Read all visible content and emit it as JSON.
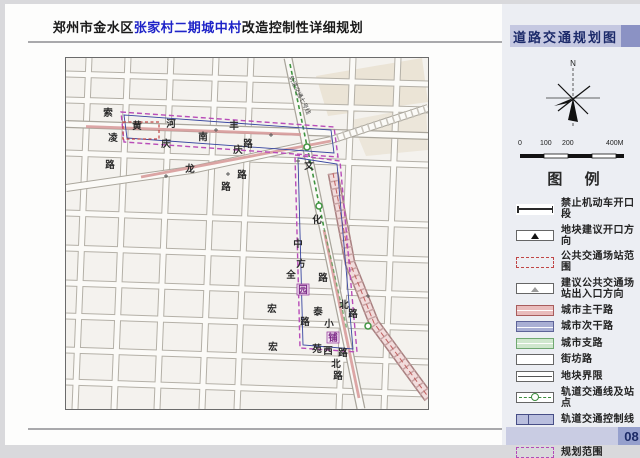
{
  "title": {
    "prefix": "郑州市金水区",
    "highlight": "张家村二期城中村",
    "suffix": "改造控制性详细规划"
  },
  "page": {
    "number": "08"
  },
  "sidebar": {
    "header": "道路交通规划图",
    "legend_title": "图  例",
    "compass_label": "N",
    "scale_labels": [
      "0",
      "100",
      "200",
      "400M"
    ],
    "legend": [
      {
        "name": "no-motor-opening",
        "label": "禁止机动车开口段",
        "type": "tick-line"
      },
      {
        "name": "parcel-opening-dir",
        "label": "地块建议开口方向",
        "type": "triangle"
      },
      {
        "name": "transit-depot-range",
        "label": "公共交通场站范围",
        "type": "red-dash"
      },
      {
        "name": "transit-entrance",
        "label": "建议公共交通场站出入口方向",
        "type": "arrow"
      },
      {
        "name": "city-arterial",
        "label": "城市主干路",
        "type": "fill",
        "fill": "#e9bcbc",
        "border": "#a85c5c"
      },
      {
        "name": "city-secondary",
        "label": "城市次干路",
        "type": "fill",
        "fill": "#a9afd4",
        "border": "#5d6398"
      },
      {
        "name": "city-branch",
        "label": "城市支路",
        "type": "fill",
        "fill": "#cfe7cd",
        "border": "#6fa871"
      },
      {
        "name": "neighborhood-road",
        "label": "街坊路",
        "type": "plain"
      },
      {
        "name": "parcel-boundary",
        "label": "地块界限",
        "type": "double-line"
      },
      {
        "name": "rail-line-stations",
        "label": "轨道交通线及站点",
        "type": "rail"
      },
      {
        "name": "rail-control-line",
        "label": "轨道交通控制线",
        "type": "fill-divided",
        "fill": "#b9bede",
        "border": "#474e86"
      },
      {
        "name": "renovation-scope",
        "label": "改造范围",
        "type": "navy-double"
      },
      {
        "name": "planning-scope",
        "label": "规划范围",
        "type": "magenta-dash"
      }
    ]
  },
  "map": {
    "rail_label": "轨道交通七号线",
    "colors": {
      "arterial_route": "#d89c9c",
      "rail_green": "#3f9440",
      "planning_magenta": "#b84cb8",
      "renovation_navy": "#3846a0"
    },
    "labels": [
      {
        "t": "索",
        "x": 42,
        "y": 58
      },
      {
        "t": "凌",
        "x": 47,
        "y": 83
      },
      {
        "t": "路",
        "x": 44,
        "y": 110
      },
      {
        "t": "黄",
        "x": 71,
        "y": 71
      },
      {
        "t": "河",
        "x": 105,
        "y": 69
      },
      {
        "t": "南",
        "x": 137,
        "y": 82
      },
      {
        "t": "路",
        "x": 182,
        "y": 89
      },
      {
        "t": "庆",
        "x": 100,
        "y": 89
      },
      {
        "t": "丰",
        "x": 168,
        "y": 71
      },
      {
        "t": "庆",
        "x": 172,
        "y": 95
      },
      {
        "t": "路",
        "x": 176,
        "y": 120
      },
      {
        "t": "龙",
        "x": 124,
        "y": 114
      },
      {
        "t": "路",
        "x": 160,
        "y": 132
      },
      {
        "t": "文",
        "x": 243,
        "y": 111
      },
      {
        "t": "化",
        "x": 251,
        "y": 165
      },
      {
        "t": "中",
        "x": 232,
        "y": 189
      },
      {
        "t": "方",
        "x": 235,
        "y": 209
      },
      {
        "t": "园",
        "x": 237,
        "y": 235,
        "boxed": true
      },
      {
        "t": "路",
        "x": 239,
        "y": 267
      },
      {
        "t": "全",
        "x": 225,
        "y": 220
      },
      {
        "t": "路",
        "x": 257,
        "y": 223
      },
      {
        "t": "泰",
        "x": 252,
        "y": 257
      },
      {
        "t": "小",
        "x": 263,
        "y": 269
      },
      {
        "t": "铺",
        "x": 267,
        "y": 283,
        "boxed": true
      },
      {
        "t": "宏",
        "x": 206,
        "y": 254
      },
      {
        "t": "宏",
        "x": 207,
        "y": 292
      },
      {
        "t": "苑",
        "x": 251,
        "y": 294
      },
      {
        "t": "西",
        "x": 262,
        "y": 296
      },
      {
        "t": "路",
        "x": 277,
        "y": 298
      },
      {
        "t": "北",
        "x": 278,
        "y": 250
      },
      {
        "t": "路",
        "x": 287,
        "y": 259
      },
      {
        "t": "北",
        "x": 270,
        "y": 309
      },
      {
        "t": "路",
        "x": 272,
        "y": 321
      }
    ]
  }
}
